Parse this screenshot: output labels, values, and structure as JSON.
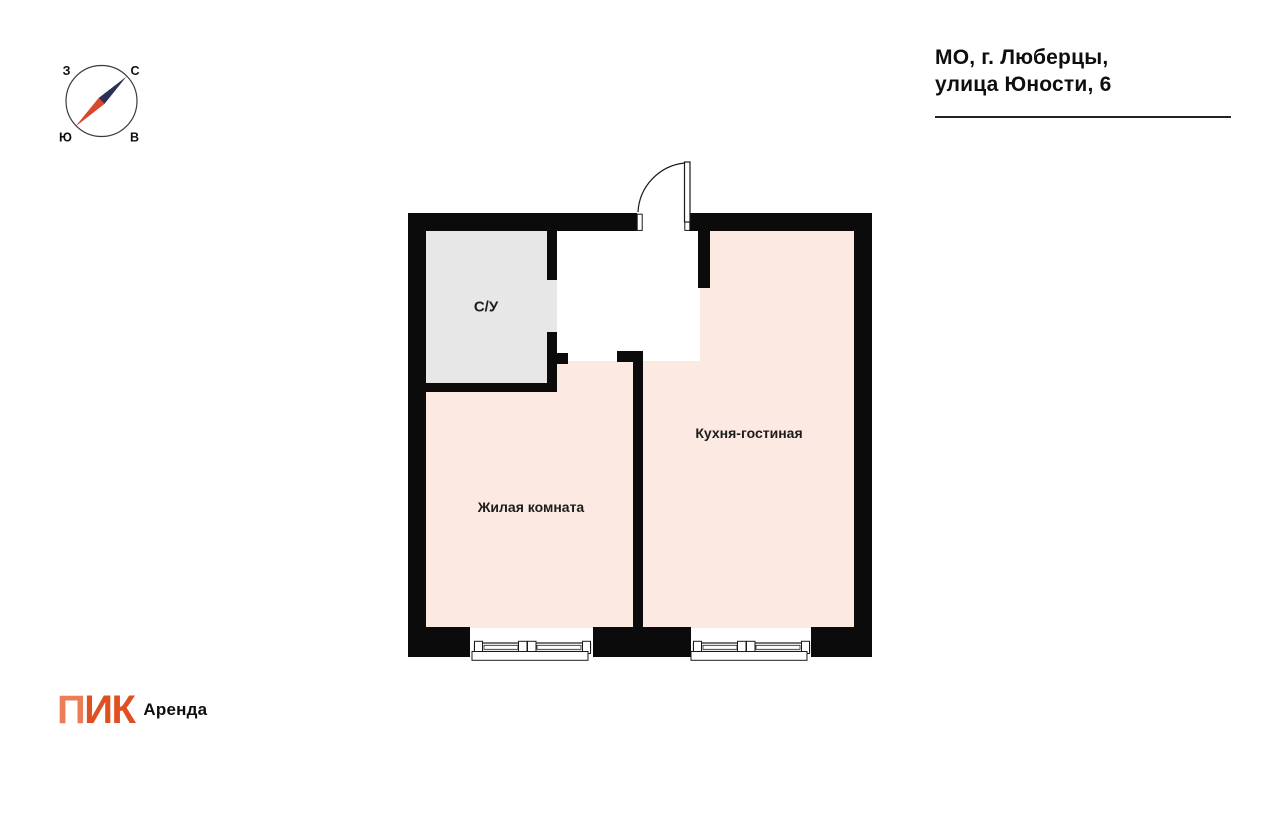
{
  "page": {
    "background": "#ffffff"
  },
  "address": {
    "line1": "МО, г. Люберцы,",
    "line2": "улица Юности, 6"
  },
  "compass": {
    "labels": {
      "west": "З",
      "north": "С",
      "south": "Ю",
      "east": "В"
    },
    "colors": {
      "north_needle": "#2e3156",
      "south_needle": "#d8492b",
      "ring": "#3a3a3a"
    }
  },
  "floorplan": {
    "wall_color": "#0b0b0b",
    "line_color": "#1a1a1a",
    "rooms": [
      {
        "name": "bathroom",
        "label": "С/У",
        "fill": "#e7e7e7"
      },
      {
        "name": "living-room",
        "label": "Жилая комната",
        "fill": "#fbe9e2"
      },
      {
        "name": "kitchen-living-room",
        "label": "Кухня-гостиная",
        "fill": "#fbe9e2"
      }
    ]
  },
  "brand": {
    "logo_first": "П",
    "logo_rest": "ИК",
    "logo_color_first": "#eb7e56",
    "logo_color_rest": "#e04f1f",
    "suffix": "Аренда"
  }
}
